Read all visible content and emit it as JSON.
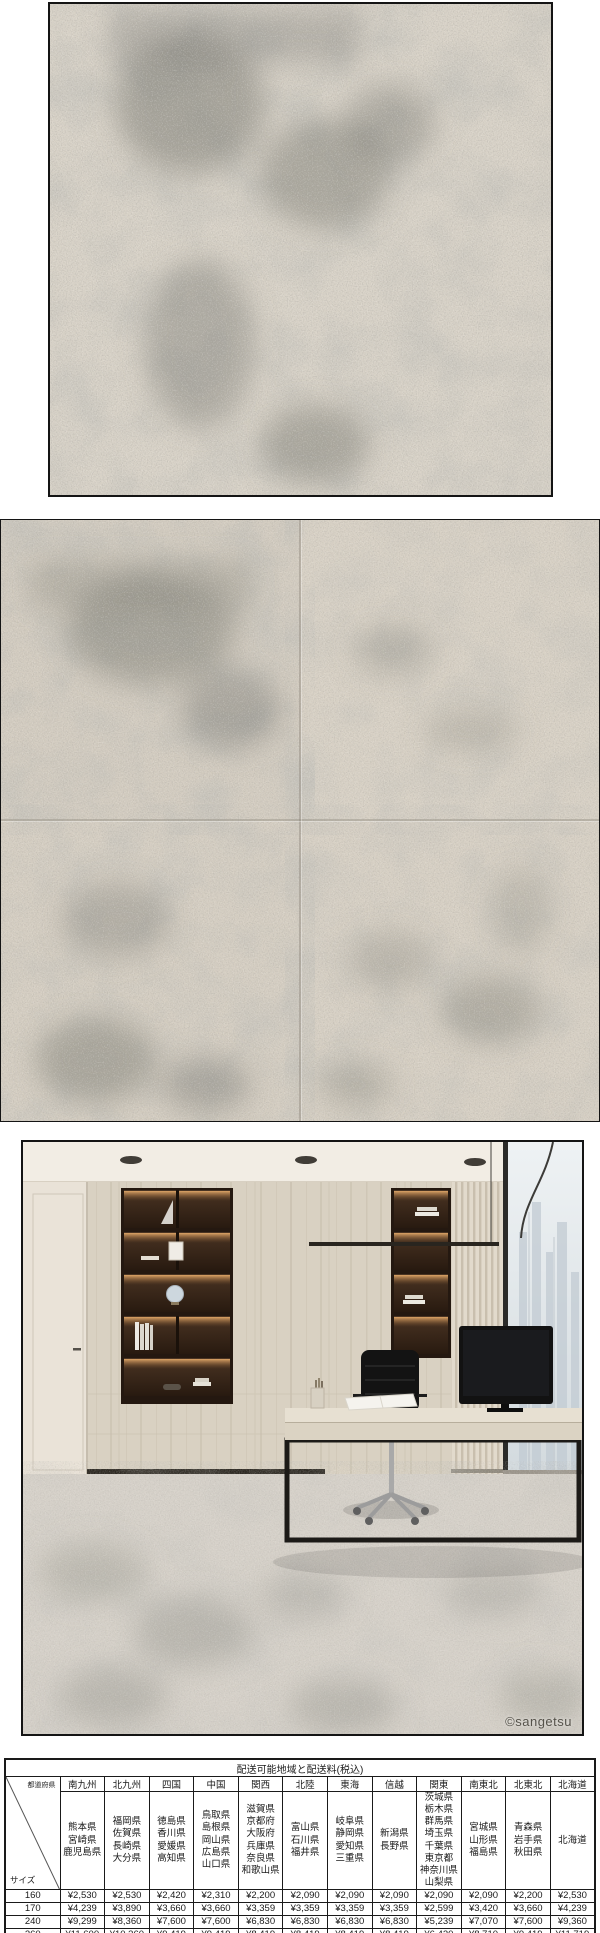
{
  "images": {
    "swatch_closeup": {
      "label": "carpet-texture-closeup"
    },
    "tile_grid": {
      "label": "carpet-tile-2x2-layout"
    },
    "room_scene": {
      "label": "office-interior-with-carpet",
      "watermark": "©sangetsu"
    }
  },
  "table": {
    "title": "配送可能地域と配送料(税込)",
    "corner": {
      "top": "都道府県",
      "bottom": "サイズ"
    },
    "columns": [
      {
        "region": "南九州",
        "prefectures": [
          "熊本県",
          "宮崎県",
          "鹿児島県"
        ]
      },
      {
        "region": "北九州",
        "prefectures": [
          "福岡県",
          "佐賀県",
          "長崎県",
          "大分県"
        ]
      },
      {
        "region": "四国",
        "prefectures": [
          "徳島県",
          "香川県",
          "愛媛県",
          "高知県"
        ]
      },
      {
        "region": "中国",
        "prefectures": [
          "鳥取県",
          "島根県",
          "岡山県",
          "広島県",
          "山口県"
        ]
      },
      {
        "region": "関西",
        "prefectures": [
          "滋賀県",
          "京都府",
          "大阪府",
          "兵庫県",
          "奈良県",
          "和歌山県"
        ]
      },
      {
        "region": "北陸",
        "prefectures": [
          "富山県",
          "石川県",
          "福井県"
        ]
      },
      {
        "region": "東海",
        "prefectures": [
          "岐阜県",
          "静岡県",
          "愛知県",
          "三重県"
        ]
      },
      {
        "region": "信越",
        "prefectures": [
          "新潟県",
          "長野県"
        ]
      },
      {
        "region": "関東",
        "prefectures": [
          "茨城県",
          "栃木県",
          "群馬県",
          "埼玉県",
          "千葉県",
          "東京都",
          "神奈川県",
          "山梨県"
        ]
      },
      {
        "region": "南東北",
        "prefectures": [
          "宮城県",
          "山形県",
          "福島県"
        ]
      },
      {
        "region": "北東北",
        "prefectures": [
          "青森県",
          "岩手県",
          "秋田県"
        ]
      },
      {
        "region": "北海道",
        "prefectures": [
          "北海道"
        ]
      }
    ],
    "rows": [
      {
        "size": "160",
        "fees": [
          "¥2,530",
          "¥2,530",
          "¥2,420",
          "¥2,310",
          "¥2,200",
          "¥2,090",
          "¥2,090",
          "¥2,090",
          "¥2,090",
          "¥2,090",
          "¥2,200",
          "¥2,530"
        ]
      },
      {
        "size": "170",
        "fees": [
          "¥4,239",
          "¥3,890",
          "¥3,660",
          "¥3,660",
          "¥3,359",
          "¥3,359",
          "¥3,359",
          "¥3,359",
          "¥2,599",
          "¥3,420",
          "¥3,660",
          "¥4,239"
        ]
      },
      {
        "size": "240",
        "fees": [
          "¥9,299",
          "¥8,360",
          "¥7,600",
          "¥7,600",
          "¥6,830",
          "¥6,830",
          "¥6,830",
          "¥6,830",
          "¥5,239",
          "¥7,070",
          "¥7,600",
          "¥9,360"
        ]
      },
      {
        "size": "260",
        "fees": [
          "¥11,600",
          "¥10,360",
          "¥9,419",
          "¥9,419",
          "¥8,419",
          "¥8,419",
          "¥8,419",
          "¥8,419",
          "¥6,420",
          "¥8,710",
          "¥9,419",
          "¥11,719"
        ]
      }
    ]
  },
  "colors": {
    "carpet_base": "#d6cfc4",
    "carpet_mottle": "#7b7b73",
    "wood_wall": "#d9d1c2",
    "niche_dark": "#241810",
    "glow_amber": "#f0aa64",
    "table_border": "#1a1a1a"
  }
}
